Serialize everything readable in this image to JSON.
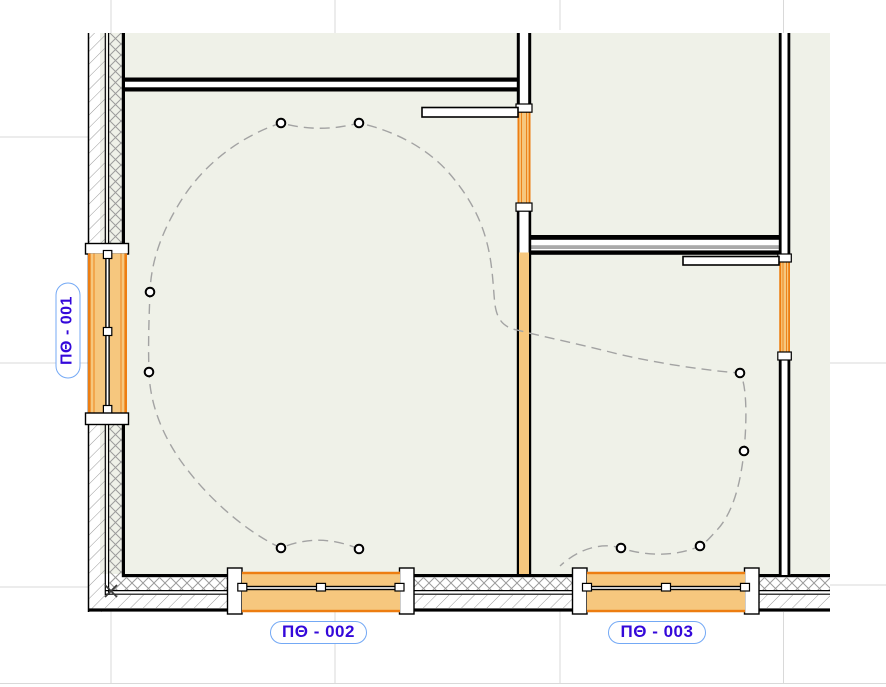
{
  "view": {
    "type": "floor-plan-canvas",
    "labels": {
      "window_001": "ПΘ - 001",
      "window_002": "ПΘ - 002",
      "window_003": "ПΘ - 003"
    },
    "symbols": {
      "lamp_count": 10,
      "window_count": 3,
      "door_leaf_count": 2
    },
    "colors": {
      "zone_fill": "#EFF1E8",
      "element_orange_fill": "#F6C77E",
      "element_orange_border": "#ED7D11",
      "wall_line": "#000000",
      "grid_line": "#D9D9D9",
      "wiring_dash": "#A3A3A3",
      "hatch_line": "#9B9B9B",
      "label_text": "#3408DA",
      "label_border": "#74A9F5"
    }
  }
}
